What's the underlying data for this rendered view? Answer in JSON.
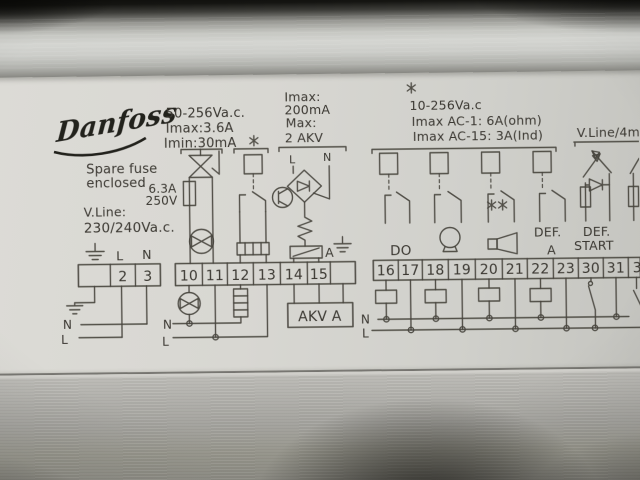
{
  "brand": {
    "logo": "Danfoss"
  },
  "specs": {
    "supply_left": {
      "l1": "50-256Va.c.",
      "l2": "Imax:3.6A",
      "l3": "Imin:30mA"
    },
    "akv_output": {
      "l1": "Imax:",
      "l2": "200mA",
      "l3": "Max:",
      "l4": "2 AKV"
    },
    "relay_outputs": {
      "l1": "10-256Va.c",
      "l2": "Imax AC-1: 6A(ohm)",
      "l3": "Imax AC-15: 3A(Ind)"
    },
    "vline_right": "V.Line/4m",
    "spare_fuse": {
      "l1": "Spare fuse",
      "l2": "enclosed"
    },
    "fuse_rating": {
      "l1": "6.3A",
      "l2": "250V"
    },
    "vline_left": {
      "l1": "V.Line:",
      "l2": "230/240Va.c."
    }
  },
  "akv": {
    "l": "L",
    "n": "N",
    "valve": "A",
    "box": "AKV A"
  },
  "blocks": {
    "power": {
      "above_l": "L",
      "above_n": "N",
      "bus_n": "N",
      "bus_l": "L",
      "terminals": [
        "",
        "2",
        "3"
      ]
    },
    "mid": {
      "bus_n": "N",
      "bus_l": "L",
      "terminals": [
        "10",
        "11",
        "12",
        "13",
        "14",
        "15",
        ""
      ]
    },
    "relays": {
      "bus_n": "N",
      "bus_l": "L",
      "do_label": "DO",
      "def_a_1": "DEF.",
      "def_a_2": "A",
      "def_start_1": "DEF.",
      "def_start_2": "START",
      "terminals": [
        "16",
        "17",
        "18",
        "19",
        "20",
        "21",
        "22",
        "23",
        "30",
        "31",
        "3"
      ]
    }
  },
  "icons": {
    "earth-icon": "⏚ ground bars",
    "star-icon": "✳ asterisk marker",
    "lamp-icon": "circle with bowtie filament",
    "resistor-icon": "segmented rectangle",
    "triac-icon": "hourglass triangles with gate",
    "fuse-icon": "rectangle with through-line",
    "relay-coil-icon": "small rectangle",
    "relay-contact-icon": "NO switch contact",
    "bridge-rectifier-icon": "diamond with diode",
    "transistor-icon": "circle with chords",
    "coil-zigzag-icon": "zigzag winding",
    "solenoid-valve-icon": "rectangle with diagonal",
    "bulb-icon": "circle with lamp base",
    "horn-icon": "box with trapezoid horn",
    "switch-icon": "pivot blade contact",
    "opto-input-icon": "crossed arrows with diode and resistor"
  },
  "colors": {
    "ink": "#47443e",
    "label_bg": "#d6d5d0",
    "metal_bright": "#d4d5d1",
    "metal_dark": "#8e8d86",
    "top_shadow": "#0c0c0a"
  }
}
